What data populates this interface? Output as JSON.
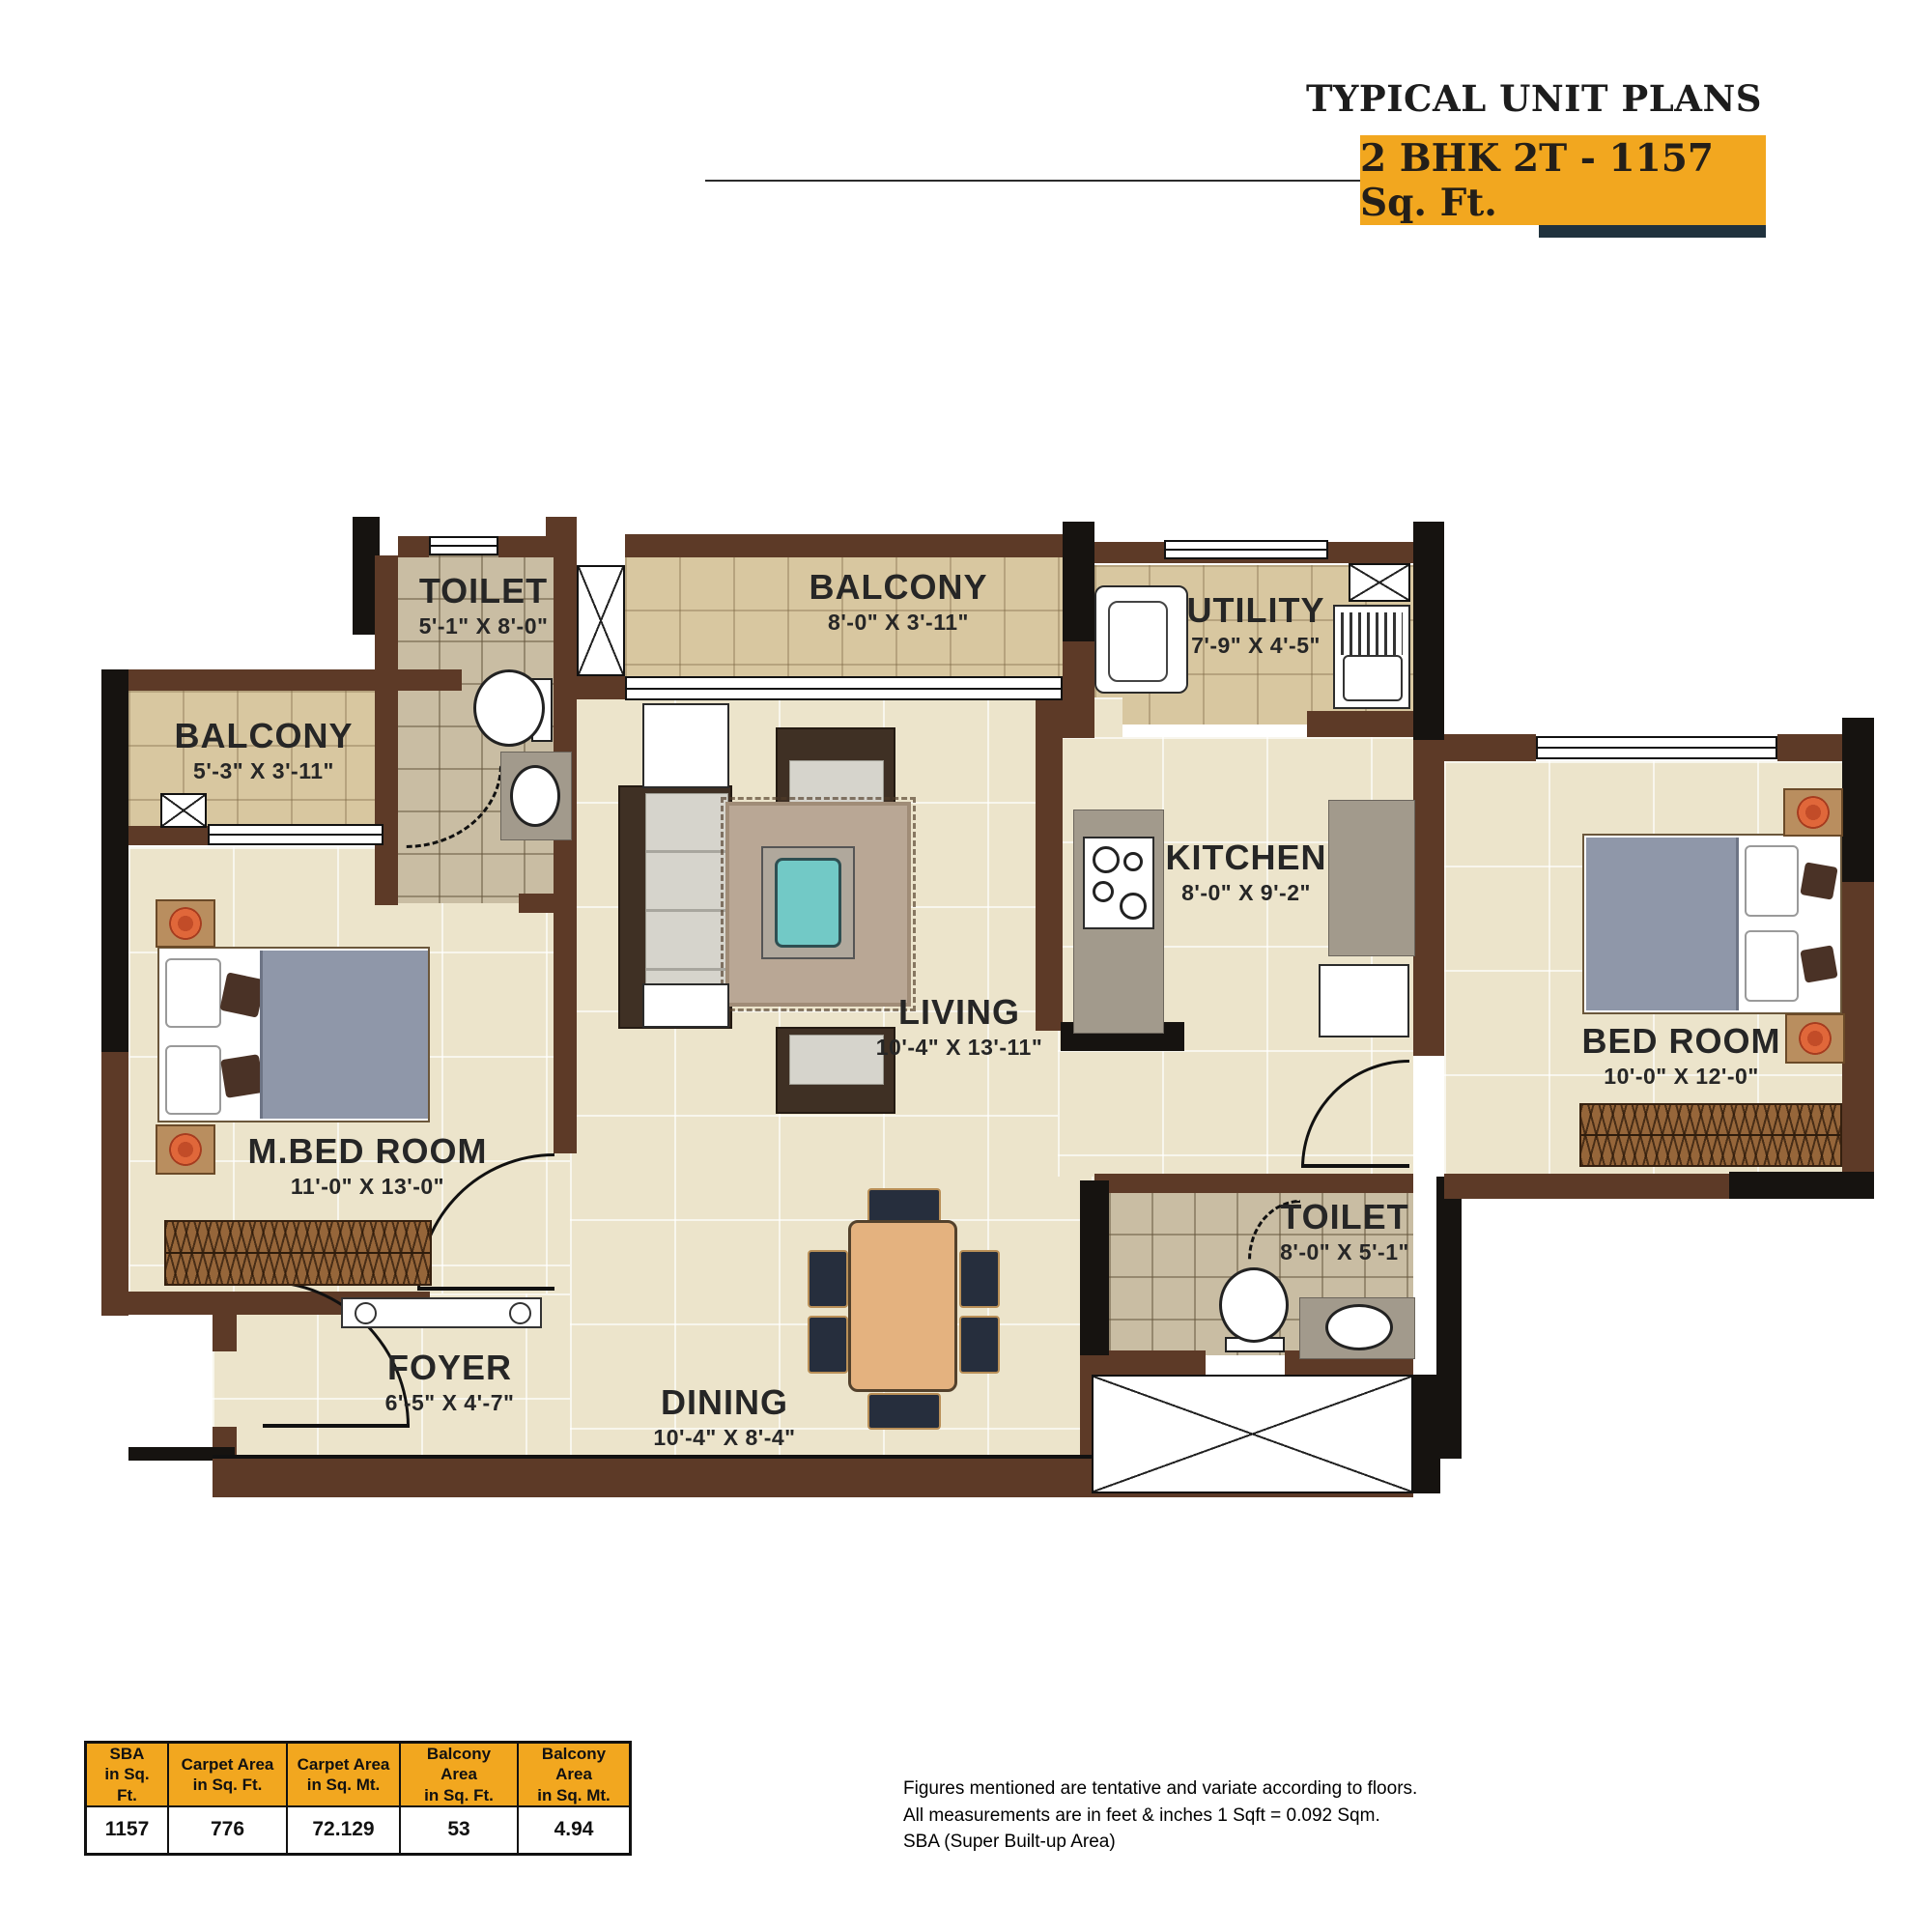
{
  "header": {
    "title": "TYPICAL UNIT PLANS",
    "banner": "2 BHK 2T - 1157 Sq. Ft."
  },
  "colors": {
    "accent_orange": "#F2A71F",
    "underbar_teal": "#20323e",
    "wall_brown": "#5d3a27",
    "floor_cream": "#ece4cb"
  },
  "rooms": [
    {
      "name": "TOILET",
      "dims": "5'-1\" X 8'-0\""
    },
    {
      "name": "BALCONY",
      "dims": "8'-0\" X 3'-11\""
    },
    {
      "name": "UTILITY",
      "dims": "7'-9\" X 4'-5\""
    },
    {
      "name": "BALCONY",
      "dims": "5'-3\" X 3'-11\""
    },
    {
      "name": "KITCHEN",
      "dims": "8'-0\" X 9'-2\""
    },
    {
      "name": "LIVING",
      "dims": "10'-4\" X 13'-11\""
    },
    {
      "name": "BED ROOM",
      "dims": "10'-0\" X 12'-0\""
    },
    {
      "name": "M.BED ROOM",
      "dims": "11'-0\" X 13'-0\""
    },
    {
      "name": "TOILET",
      "dims": "8'-0\" X 5'-1\""
    },
    {
      "name": "FOYER",
      "dims": "6'-5\" X 4'-7\""
    },
    {
      "name": "DINING",
      "dims": "10'-4\" X 8'-4\""
    }
  ],
  "area_table": {
    "headers": [
      {
        "l1": "SBA",
        "l2": "in Sq. Ft."
      },
      {
        "l1": "Carpet Area",
        "l2": "in Sq. Ft."
      },
      {
        "l1": "Carpet Area",
        "l2": "in Sq. Mt."
      },
      {
        "l1": "Balcony Area",
        "l2": "in Sq. Ft."
      },
      {
        "l1": "Balcony Area",
        "l2": "in Sq. Mt."
      }
    ],
    "values": [
      "1157",
      "776",
      "72.129",
      "53",
      "4.94"
    ]
  },
  "notes": [
    "Figures mentioned are tentative and variate according to floors.",
    "All measurements are in feet & inches 1 Sqft = 0.092 Sqm.",
    "SBA (Super Built-up Area)"
  ]
}
